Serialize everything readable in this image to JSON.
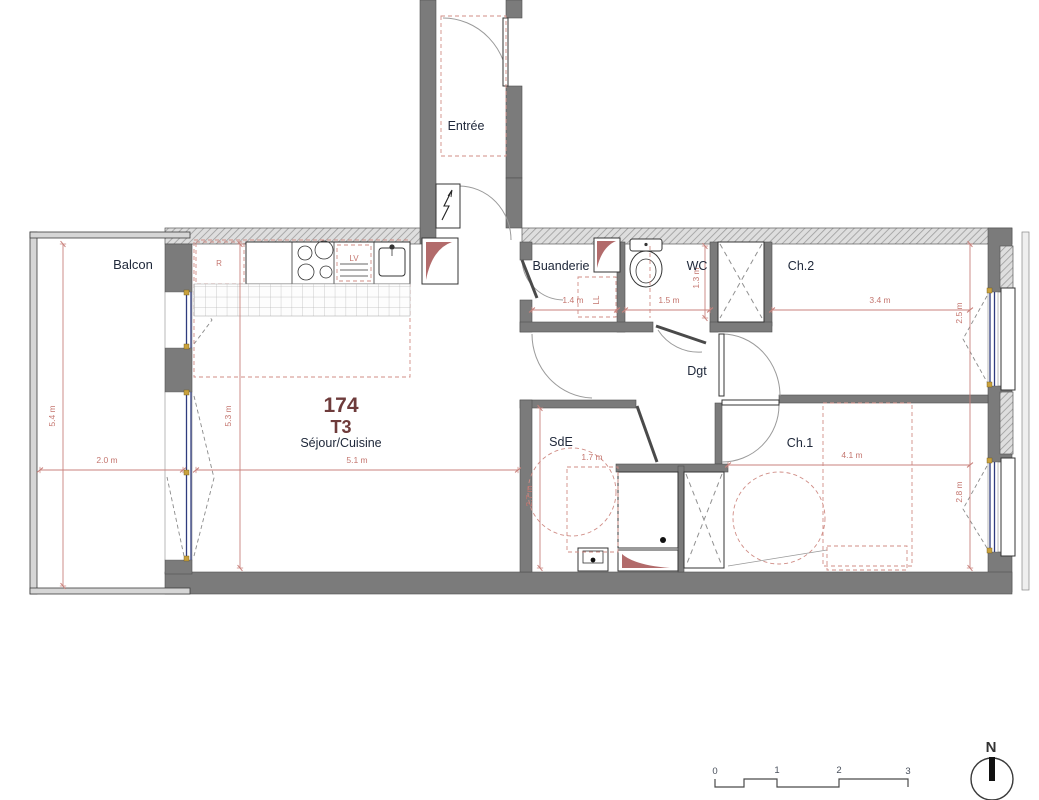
{
  "plan": {
    "unit": {
      "number": "174",
      "type": "T3"
    },
    "rooms": {
      "entree": "Entrée",
      "balcon": "Balcon",
      "sejour": "Séjour/Cuisine",
      "buanderie": "Buanderie",
      "wc": "WC",
      "ch2": "Ch.2",
      "dgt": "Dgt",
      "sde": "SdE",
      "ch1": "Ch.1"
    },
    "appliances": {
      "fridge": "R",
      "dishwasher": "LV",
      "washer": "LL"
    },
    "dimensions": {
      "balcon_w": "2.0 m",
      "balcon_h": "5.4 m",
      "sejour_w": "5.1 m",
      "sejour_h": "5.3 m",
      "buanderie_w": "1.4 m",
      "wc_w": "1.5 m",
      "wc_h": "1.3 m",
      "ch2_w": "3.4 m",
      "ch2_h": "2.5 m",
      "sde_w": "1.7 m",
      "sde_h": "2.7 m",
      "ch1_w": "4.1 m",
      "ch1_h": "2.8 m"
    },
    "scale_bar": {
      "ticks": [
        "0",
        "1",
        "2",
        "3"
      ]
    },
    "north": "N",
    "colors": {
      "wall": "#7b7b7b",
      "dimension": "#c4766f",
      "room_label": "#20293b",
      "unit_label": "#6e3b3b",
      "window": "#2f3c7e",
      "shaft": "#b26b6b"
    }
  }
}
